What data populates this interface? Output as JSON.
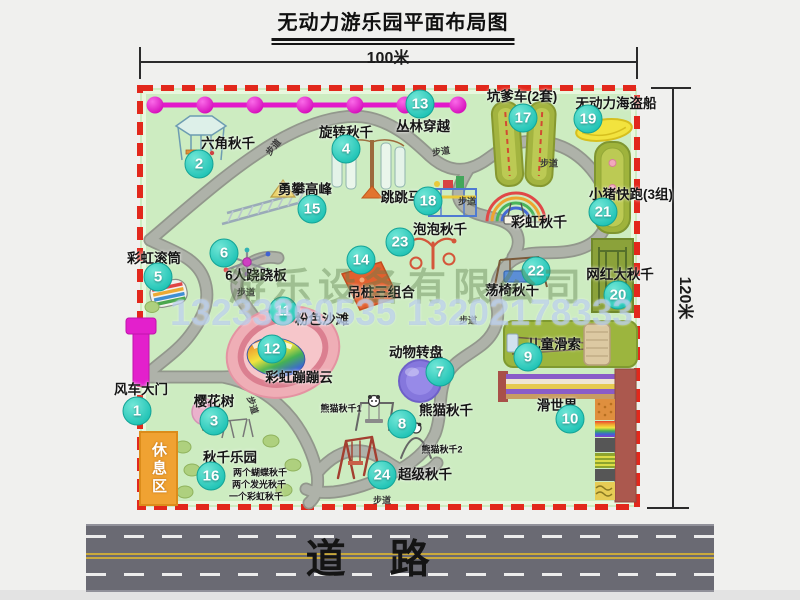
{
  "title": "无动力游乐园平面布局图",
  "dim_width": "100米",
  "dim_height": "120米",
  "road": {
    "label": "道　路"
  },
  "rest_area": "休息区",
  "watermark": {
    "company": "游乐设备有限公司",
    "phone": "13233860535 13202178333"
  },
  "colors": {
    "map_green": "#cdecc1",
    "border_red": "#e2281c",
    "badge_teal": "#22c4b6",
    "chain_magenta": "#e218ca",
    "road_gray": "#6a6a73",
    "rest_orange": "#f0a232"
  },
  "attractions": [
    {
      "num": "1",
      "name": "风车大门",
      "bx": 137,
      "by": 411,
      "lx": 141,
      "ly": 388
    },
    {
      "num": "2",
      "name": "六角秋千",
      "bx": 199,
      "by": 164,
      "lx": 228,
      "ly": 142
    },
    {
      "num": "3",
      "name": "樱花树",
      "bx": 214,
      "by": 421,
      "lx": 214,
      "ly": 400
    },
    {
      "num": "4",
      "name": "旋转秋千",
      "bx": 346,
      "by": 149,
      "lx": 346,
      "ly": 131
    },
    {
      "num": "5",
      "name": "彩虹滚筒",
      "bx": 158,
      "by": 277,
      "lx": 154,
      "ly": 257
    },
    {
      "num": "6",
      "name": "6人跷跷板",
      "bx": 224,
      "by": 253,
      "lx": 256,
      "ly": 274
    },
    {
      "num": "7",
      "name": "动物转盘",
      "bx": 440,
      "by": 372,
      "lx": 416,
      "ly": 351
    },
    {
      "num": "8",
      "name": "熊猫秋千",
      "bx": 402,
      "by": 424,
      "lx": 446,
      "ly": 409
    },
    {
      "num": "9",
      "name": "儿童滑索",
      "bx": 528,
      "by": 357,
      "lx": 554,
      "ly": 343
    },
    {
      "num": "10",
      "name": "滑世界",
      "bx": 570,
      "by": 419,
      "lx": 557,
      "ly": 404
    },
    {
      "num": "11",
      "name": "粉色沙滩",
      "bx": 283,
      "by": 311,
      "lx": 322,
      "ly": 318
    },
    {
      "num": "12",
      "name": "彩虹蹦蹦云",
      "bx": 272,
      "by": 349,
      "lx": 299,
      "ly": 376
    },
    {
      "num": "13",
      "name": "丛林穿越",
      "bx": 420,
      "by": 104,
      "lx": 423,
      "ly": 125
    },
    {
      "num": "14",
      "name": "吊桩三组合",
      "bx": 361,
      "by": 260,
      "lx": 381,
      "ly": 291
    },
    {
      "num": "15",
      "name": "勇攀高峰",
      "bx": 312,
      "by": 209,
      "lx": 305,
      "ly": 188
    },
    {
      "num": "16",
      "name": "秋千乐园",
      "bx": 211,
      "by": 476,
      "lx": 230,
      "ly": 456
    },
    {
      "num": "17",
      "name": "坑爹车(2套)",
      "bx": 523,
      "by": 118,
      "lx": 522,
      "ly": 95
    },
    {
      "num": "18",
      "name": "跳跳马",
      "bx": 428,
      "by": 201,
      "lx": 401,
      "ly": 196
    },
    {
      "num": "19",
      "name": "无动力海盗船",
      "bx": 588,
      "by": 119,
      "lx": 616,
      "ly": 102
    },
    {
      "num": "20",
      "name": "网红大秋千",
      "bx": 618,
      "by": 295,
      "lx": 620,
      "ly": 273
    },
    {
      "num": "21",
      "name": "小猪快跑(3组)",
      "bx": 603,
      "by": 212,
      "lx": 631,
      "ly": 193
    },
    {
      "num": "22",
      "name": "荡椅秋千",
      "bx": 536,
      "by": 271,
      "lx": 512,
      "ly": 289
    },
    {
      "num": "23",
      "name": "泡泡秋千",
      "bx": 400,
      "by": 242,
      "lx": 440,
      "ly": 228
    },
    {
      "num": "24",
      "name": "超级秋千",
      "bx": 382,
      "by": 475,
      "lx": 425,
      "ly": 473
    }
  ],
  "extra_labels": [
    {
      "text": "彩虹秋千",
      "x": 539,
      "y": 222,
      "size": 14
    },
    {
      "text": "熊猫秋千1",
      "x": 341,
      "y": 408,
      "size": 9
    },
    {
      "text": "熊猫秋千2",
      "x": 442,
      "y": 449,
      "size": 9
    },
    {
      "text": "两个蝴蝶秋千",
      "x": 260,
      "y": 472,
      "size": 9
    },
    {
      "text": "两个发光秋千",
      "x": 259,
      "y": 484,
      "size": 9
    },
    {
      "text": "一个彩虹秋千",
      "x": 256,
      "y": 496,
      "size": 9
    }
  ],
  "walkway_labels": [
    {
      "text": "步道",
      "x": 273,
      "y": 147,
      "rot": -50
    },
    {
      "text": "步道",
      "x": 441,
      "y": 151,
      "rot": -8
    },
    {
      "text": "步道",
      "x": 549,
      "y": 163,
      "rot": 0
    },
    {
      "text": "步道",
      "x": 467,
      "y": 201,
      "rot": 0
    },
    {
      "text": "步道",
      "x": 246,
      "y": 292,
      "rot": 0
    },
    {
      "text": "步道",
      "x": 468,
      "y": 320,
      "rot": 0
    },
    {
      "text": "步道",
      "x": 253,
      "y": 405,
      "rot": 72
    },
    {
      "text": "步道",
      "x": 382,
      "y": 500,
      "rot": 0
    }
  ],
  "chain": {
    "y": 105,
    "x1": 150,
    "x2": 462,
    "dots": [
      155,
      205,
      255,
      305,
      355,
      405,
      458
    ]
  }
}
